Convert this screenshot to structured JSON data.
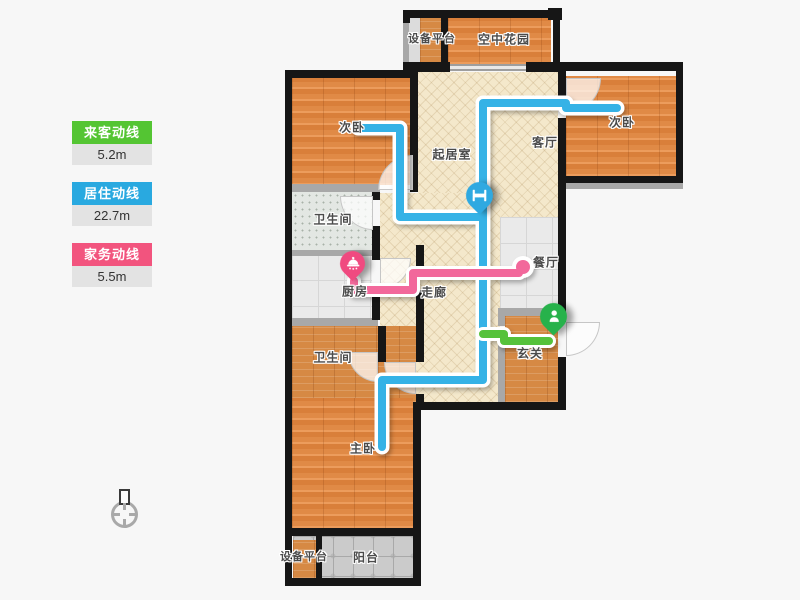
{
  "legend": {
    "items": [
      {
        "id": "visitor-route",
        "label": "来客动线",
        "value": "5.2m",
        "color": "#54c533"
      },
      {
        "id": "resident-route",
        "label": "居住动线",
        "value": "22.7m",
        "color": "#29a9e0"
      },
      {
        "id": "housework-route",
        "label": "家务动线",
        "value": "5.5m",
        "color": "#f2547e"
      }
    ]
  },
  "floorplan": {
    "rooms": [
      {
        "id": "equipment-platform-top",
        "label": "设备平台"
      },
      {
        "id": "sky-garden",
        "label": "空中花园"
      },
      {
        "id": "bedroom-left",
        "label": "次卧"
      },
      {
        "id": "bedroom-right",
        "label": "次卧"
      },
      {
        "id": "living-room",
        "label": "起居室"
      },
      {
        "id": "lounge",
        "label": "客厅"
      },
      {
        "id": "bathroom-top",
        "label": "卫生间"
      },
      {
        "id": "kitchen",
        "label": "厨房"
      },
      {
        "id": "corridor",
        "label": "走廊"
      },
      {
        "id": "dining-room",
        "label": "餐厅"
      },
      {
        "id": "entrance",
        "label": "玄关"
      },
      {
        "id": "bathroom-bottom",
        "label": "卫生间"
      },
      {
        "id": "master-bedroom",
        "label": "主卧"
      },
      {
        "id": "equipment-platform-bottom",
        "label": "设备平台"
      },
      {
        "id": "balcony",
        "label": "阳台"
      }
    ],
    "routes": [
      {
        "id": "resident-route",
        "color": "#35b2e6",
        "icon": "bed-icon",
        "length": "22.7m"
      },
      {
        "id": "housework-route",
        "color": "#f2679b",
        "icon": "pot-icon",
        "length": "5.5m"
      },
      {
        "id": "visitor-route",
        "color": "#55c23a",
        "icon": "person-icon",
        "length": "5.2m"
      }
    ],
    "compass": "north-indicator"
  }
}
